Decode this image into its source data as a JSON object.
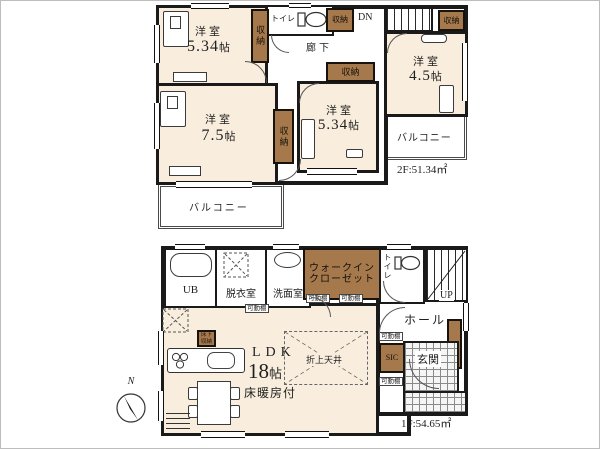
{
  "compass": {
    "north_label": "N"
  },
  "colors": {
    "room_fill": "#f9eedd",
    "closet_fill": "#a5794b",
    "wall": "#1a1a1a"
  },
  "floor2": {
    "area_label": "2F:51.34㎡",
    "labels": {
      "closet": "収納",
      "toilet": "トイレ",
      "hallway": "廊下",
      "stairs_down": "DN",
      "balcony": "バルコニー"
    },
    "rooms": {
      "bedroom_nw": {
        "type": "洋室",
        "size_num": "5.34",
        "size_unit": "帖"
      },
      "bedroom_sw": {
        "type": "洋室",
        "size_num": "7.5",
        "size_unit": "帖"
      },
      "bedroom_center": {
        "type": "洋室",
        "size_num": "5.34",
        "size_unit": "帖"
      },
      "bedroom_ne": {
        "type": "洋室",
        "size_num": "4.5",
        "size_unit": "帖"
      }
    }
  },
  "floor1": {
    "area_label": "1F:54.65㎡",
    "labels": {
      "unit_bath": "UB",
      "dressing_room": "脱衣室",
      "washroom": "洗面室",
      "wic_line1": "ウォークイン",
      "wic_line2": "クローゼット",
      "movable_shelf": "可動棚",
      "toilet": "トイレ",
      "stairs_up": "UP",
      "hall": "ホール",
      "shoe_closet": "SIC",
      "entrance": "玄関",
      "raised_ceiling": "折上天井",
      "floor_storage_line1": "床下",
      "floor_storage_line2": "収納"
    },
    "ldk": {
      "name": "LDK",
      "size_num": "18",
      "size_unit": "帖",
      "feature": "床暖房付"
    }
  }
}
